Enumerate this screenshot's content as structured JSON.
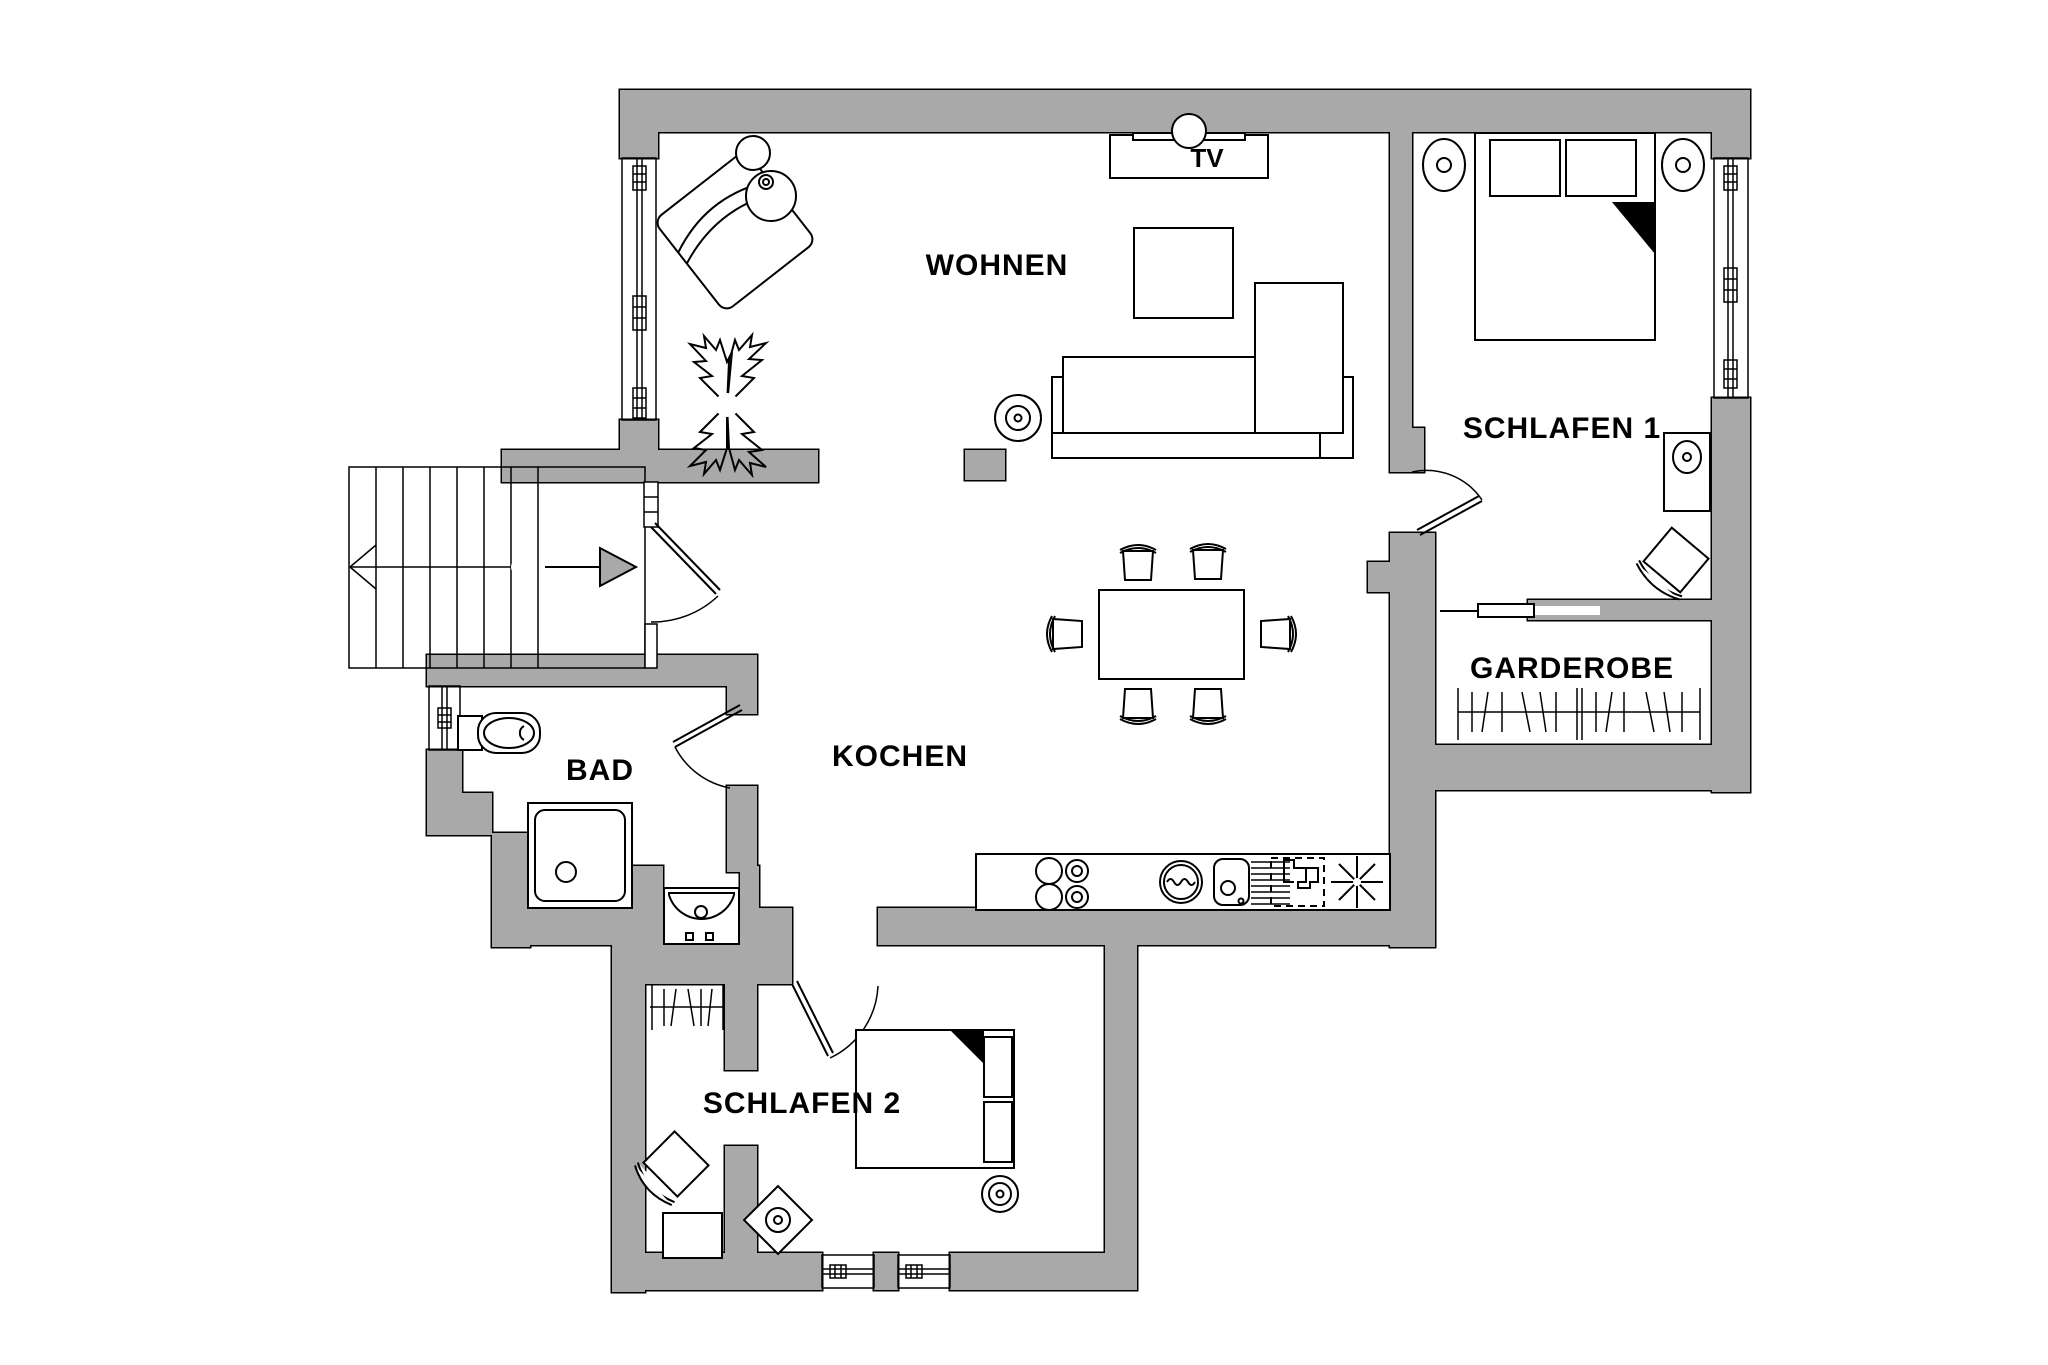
{
  "meta": {
    "kind": "architectural floor plan",
    "language": "de"
  },
  "colors": {
    "wall_fill": "#a9a9a9",
    "outline": "#000000",
    "floor": "#ffffff",
    "arrow_fill": "#a9a9a9"
  },
  "rooms": {
    "wohnen": {
      "label": "WOHNEN"
    },
    "schlafen1": {
      "label": "SCHLAFEN 1"
    },
    "garderobe": {
      "label": "GARDEROBE"
    },
    "bad": {
      "label": "BAD"
    },
    "kochen": {
      "label": "KOCHEN"
    },
    "schlafen2": {
      "label": "SCHLAFEN 2"
    }
  },
  "labels": {
    "tv": "TV"
  },
  "stairs": {
    "treads": 7,
    "direction_arrow": "points right into entrance",
    "walk_line": "circle at start, arrowhead at end"
  },
  "doors": [
    {
      "name": "entrance-door",
      "between": "stair landing and hall"
    },
    {
      "name": "bad-door",
      "between": "hall and bathroom"
    },
    {
      "name": "schlafen1-door",
      "between": "living area and bedroom 1"
    },
    {
      "name": "schlafen2-door",
      "between": "kitchen area and bedroom 2"
    },
    {
      "name": "garderobe-sliding-door",
      "between": "bedroom 1 and wardrobe room"
    }
  ],
  "windows": [
    {
      "name": "wohnen-window",
      "wall": "left"
    },
    {
      "name": "schlafen1-window",
      "wall": "right"
    },
    {
      "name": "bad-window",
      "wall": "left"
    },
    {
      "name": "schlafen2-window-1",
      "wall": "bottom"
    },
    {
      "name": "schlafen2-window-2",
      "wall": "bottom"
    }
  ],
  "kitchen": {
    "appliances": [
      "counter",
      "cooktop-4-burners",
      "washing-machine-icon",
      "sink-icon",
      "dishwasher-icon",
      "refrigerator-snowflake-icon"
    ]
  },
  "furniture": {
    "wohnen": [
      "armchair",
      "floor-lamp-icon",
      "plant-icon",
      "tv-lowboard",
      "coffee-table",
      "corner-sofa",
      "speaker-icon",
      "dining-table",
      "dining-chairs-x6"
    ],
    "schlafen1": [
      "double-bed",
      "bedside-lamp-icon-left",
      "bedside-lamp-icon-right",
      "desk-with-lamp",
      "chair"
    ],
    "garderobe": [
      "clothes-rail"
    ],
    "bad": [
      "wc",
      "shower",
      "washbasin"
    ],
    "schlafen2": [
      "closet-clothes-rail",
      "chair",
      "side-table",
      "table-lamp-icon",
      "double-bed",
      "round-lamp-icon"
    ]
  }
}
